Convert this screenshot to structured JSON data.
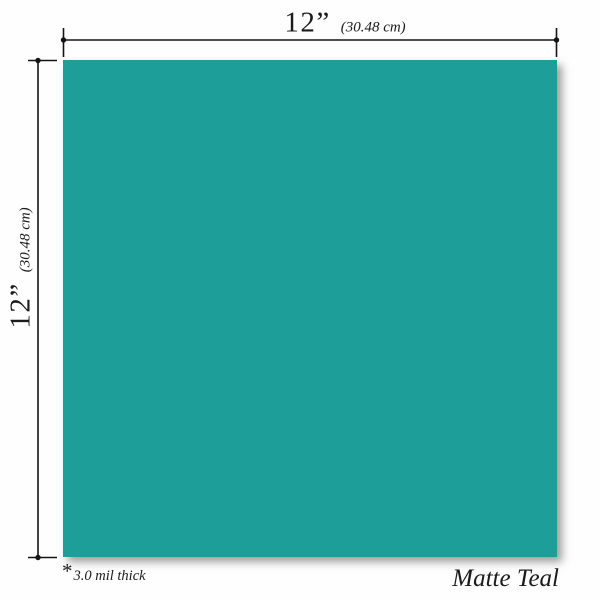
{
  "swatch": {
    "color_hex": "#1E9E99",
    "color_name": "Matte Teal"
  },
  "dimensions": {
    "top": {
      "value": "12”",
      "metric": "(30.48 cm)"
    },
    "left": {
      "value": "12”",
      "metric": "(30.48 cm)"
    }
  },
  "footnote": {
    "marker": "*",
    "text": "3.0 mil thick"
  }
}
